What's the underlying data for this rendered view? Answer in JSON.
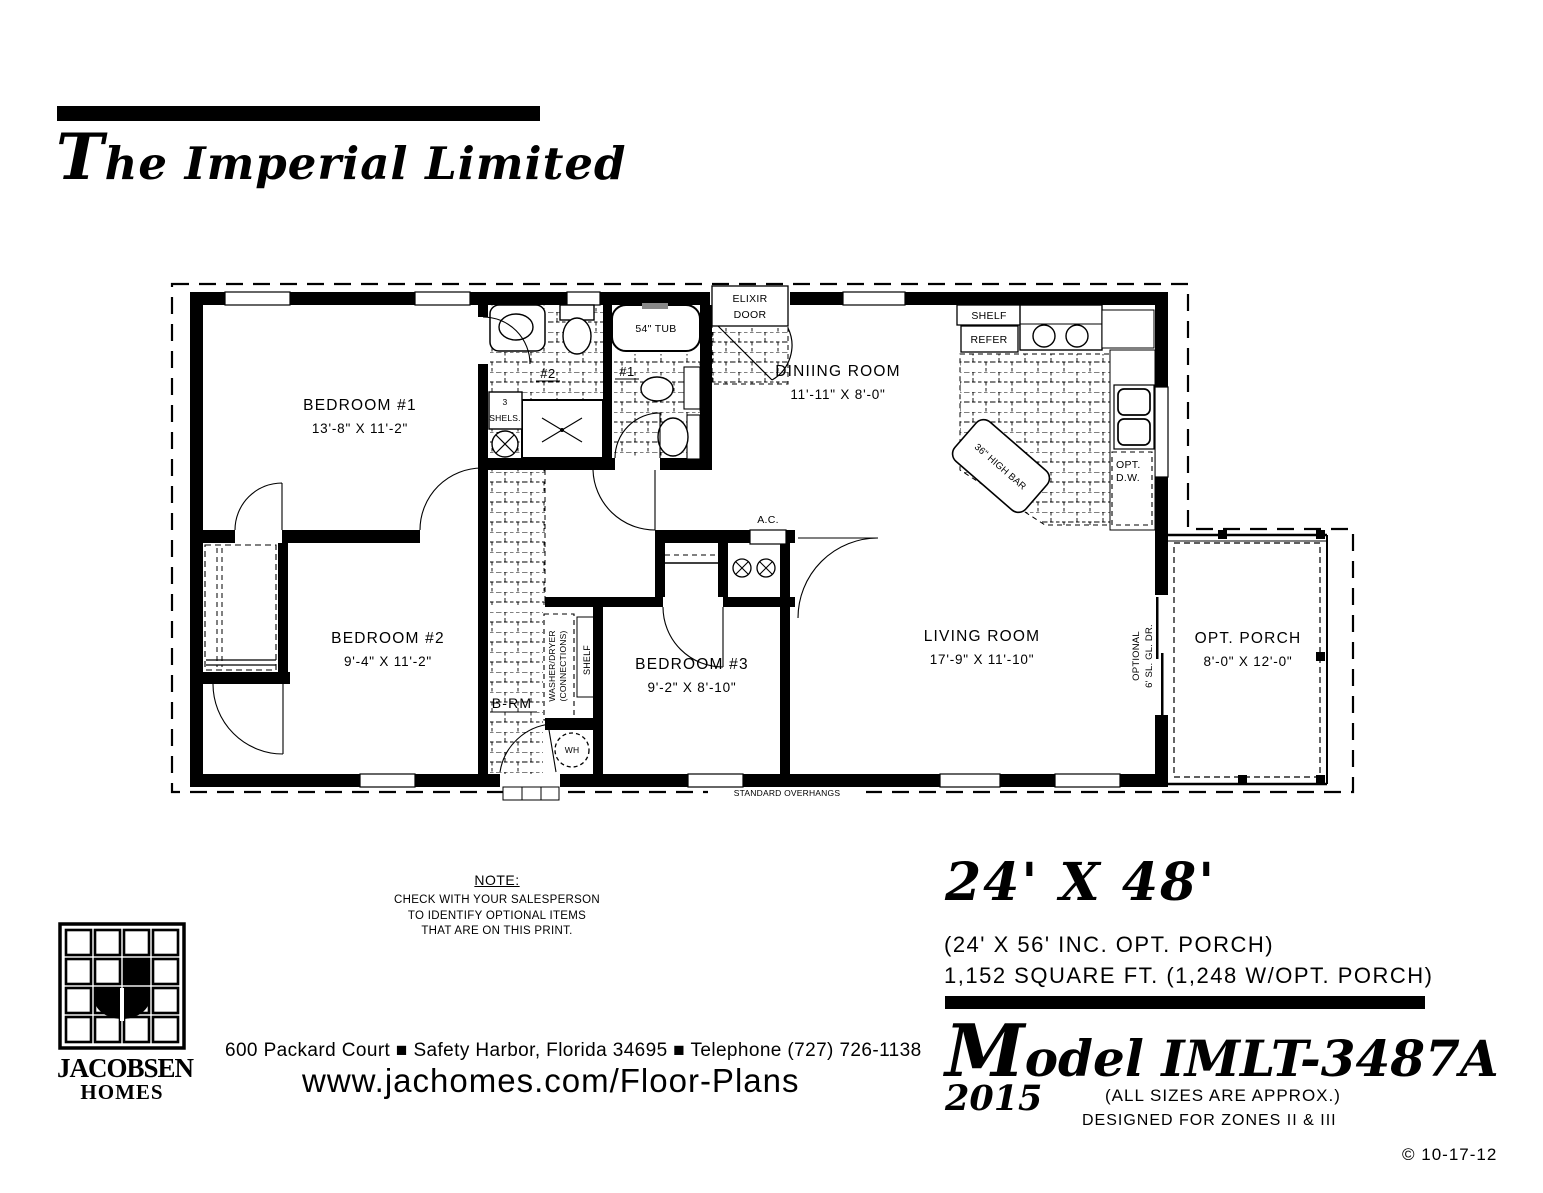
{
  "header": {
    "title": "The Imperial Limited"
  },
  "plan": {
    "rooms": {
      "bedroom1": {
        "name": "BEDROOM #1",
        "dims": "13'-8\" X 11'-2\""
      },
      "bedroom2": {
        "name": "BEDROOM #2",
        "dims": "9'-4\" X 11'-2\""
      },
      "bedroom3": {
        "name": "BEDROOM #3",
        "dims": "9'-2\" X 8'-10\""
      },
      "dining": {
        "name": "DINIING ROOM",
        "dims": "11'-11\" X 8'-0\""
      },
      "living": {
        "name": "LIVING ROOM",
        "dims": "17'-9\" X 11'-10\""
      },
      "porch": {
        "name": "OPT. PORCH",
        "dims": "8'-0\" X 12'-0\""
      }
    },
    "labels": {
      "elixir1": "ELIXIR",
      "elixir2": "DOOR",
      "tub": "54\" TUB",
      "bath1": "#1",
      "bath2": "#2",
      "shels_num": "3",
      "shels": "SHELS.",
      "shelf": "SHELF",
      "refer": "REFER",
      "high_bar": "36\" HIGH BAR",
      "opt_dw1": "OPT.",
      "opt_dw2": "D.W.",
      "ac": "A.C.",
      "brm": "B-RM",
      "washer": "WASHER/DRYER",
      "connections": "(CONNECTIONS)",
      "shelf_vert": "SHELF",
      "wh": "WH",
      "optional1": "OPTIONAL",
      "optional2": "6' SL. GL. DR.",
      "overhangs": "STANDARD OVERHANGS"
    }
  },
  "note": {
    "heading": "NOTE:",
    "line1": "CHECK WITH YOUR SALESPERSON",
    "line2": "TO IDENTIFY OPTIONAL ITEMS",
    "line3": "THAT ARE ON THIS PRINT."
  },
  "specs": {
    "size": "24' X 48'",
    "alt_size": "(24' X 56' INC. OPT. PORCH)",
    "sqft": "1,152 SQUARE FT. (1,248 W/OPT. PORCH)",
    "model": "Model IMLT-3487A",
    "year": "2015",
    "approx": "(ALL SIZES ARE APPROX.)",
    "zones": "DESIGNED FOR ZONES II & III",
    "copyright": "© 10-17-12"
  },
  "footer": {
    "logo_line1": "JACOBSEN",
    "logo_line2": "HOMES",
    "address": "600 Packard Court ■ Safety Harbor, Florida 34695 ■ Telephone (727) 726-1138",
    "website": "www.jachomes.com/Floor-Plans"
  }
}
